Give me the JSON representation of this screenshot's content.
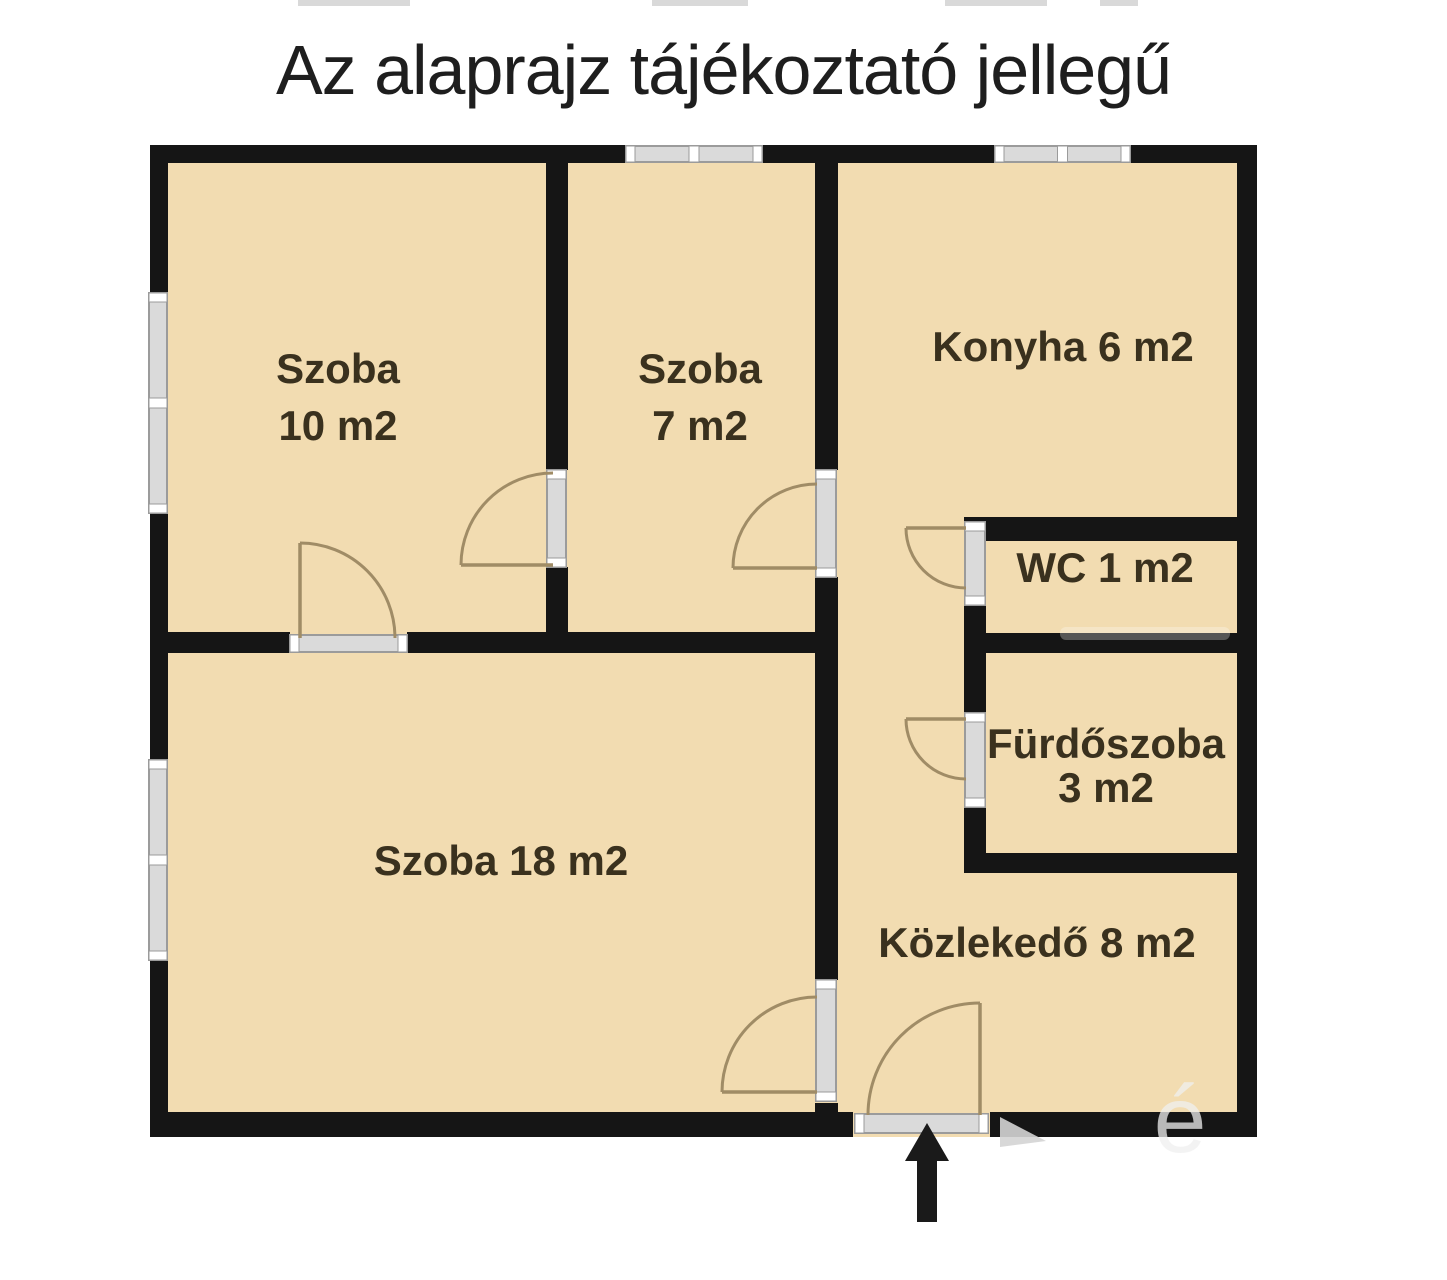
{
  "title": {
    "text": "Az alaprajz tájékoztató jellegű"
  },
  "colors": {
    "background": "#ffffff",
    "floor": "#f2dcb1",
    "wall": "#151515",
    "frame_fill": "#dadada",
    "frame_edge": "#9b9b9b",
    "frame_cap": "#ffffff",
    "arc": "#a08c66",
    "label": "#3a311e",
    "title": "#1e1e1e",
    "arrow": "#1a1a1a",
    "watermark": "#d4d4d4"
  },
  "floor": {
    "x": 150,
    "y": 145,
    "w": 1107,
    "h": 992
  },
  "walls": [
    {
      "name": "outer-top",
      "x": 150,
      "y": 145,
      "w": 1107,
      "h": 18
    },
    {
      "name": "outer-left",
      "x": 150,
      "y": 145,
      "w": 18,
      "h": 992
    },
    {
      "name": "outer-right",
      "x": 1237,
      "y": 145,
      "w": 20,
      "h": 992
    },
    {
      "name": "outer-bottom-left",
      "x": 150,
      "y": 1112,
      "w": 703,
      "h": 25
    },
    {
      "name": "outer-bottom-right",
      "x": 990,
      "y": 1112,
      "w": 267,
      "h": 25
    },
    {
      "name": "divider-szoba10-szoba7-upper",
      "x": 546,
      "y": 163,
      "w": 22,
      "h": 307
    },
    {
      "name": "divider-szoba10-szoba7-lower",
      "x": 546,
      "y": 567,
      "w": 22,
      "h": 86
    },
    {
      "name": "central-wall-upper",
      "x": 815,
      "y": 163,
      "w": 23,
      "h": 307
    },
    {
      "name": "central-wall-middle",
      "x": 815,
      "y": 577,
      "w": 23,
      "h": 403
    },
    {
      "name": "central-wall-stub",
      "x": 815,
      "y": 1103,
      "w": 23,
      "h": 9
    },
    {
      "name": "szoba10-szoba18-wall-left",
      "x": 168,
      "y": 632,
      "w": 122,
      "h": 21
    },
    {
      "name": "szoba10-szoba18-wall-right",
      "x": 407,
      "y": 632,
      "w": 431,
      "h": 21
    },
    {
      "name": "konyha-bottom-wall",
      "x": 964,
      "y": 517,
      "w": 273,
      "h": 24
    },
    {
      "name": "wc-furdo-divider-wall",
      "x": 964,
      "y": 633,
      "w": 273,
      "h": 20
    },
    {
      "name": "furdo-bottom-wall",
      "x": 964,
      "y": 853,
      "w": 273,
      "h": 20
    },
    {
      "name": "wc-left-wall",
      "x": 964,
      "y": 605,
      "w": 22,
      "h": 108
    },
    {
      "name": "furdo-left-wall",
      "x": 964,
      "y": 807,
      "w": 22,
      "h": 46
    }
  ],
  "windows": [
    {
      "name": "window-top-szoba7",
      "x": 626,
      "y": 146,
      "w": 136,
      "h": 16,
      "orient": "h"
    },
    {
      "name": "window-top-konyha",
      "x": 995,
      "y": 146,
      "w": 135,
      "h": 16,
      "orient": "h"
    },
    {
      "name": "window-left-szoba10",
      "x": 149,
      "y": 293,
      "w": 18,
      "h": 220,
      "orient": "v"
    },
    {
      "name": "window-left-szoba18",
      "x": 149,
      "y": 760,
      "w": 18,
      "h": 200,
      "orient": "v"
    }
  ],
  "door_frames": [
    {
      "name": "doorframe-szoba10",
      "x": 290,
      "y": 635,
      "w": 117,
      "h": 17,
      "orient": "h"
    },
    {
      "name": "doorframe-szoba10-szoba7",
      "x": 547,
      "y": 470,
      "w": 19,
      "h": 97,
      "orient": "v"
    },
    {
      "name": "doorframe-szoba7-hall",
      "x": 816,
      "y": 470,
      "w": 20,
      "h": 107,
      "orient": "v"
    },
    {
      "name": "doorframe-wc",
      "x": 965,
      "y": 522,
      "w": 20,
      "h": 83,
      "orient": "v"
    },
    {
      "name": "doorframe-furdoszoba",
      "x": 965,
      "y": 713,
      "w": 20,
      "h": 94,
      "orient": "v"
    },
    {
      "name": "doorframe-szoba18-hall",
      "x": 816,
      "y": 980,
      "w": 20,
      "h": 121,
      "orient": "v"
    },
    {
      "name": "doorframe-entrance",
      "x": 855,
      "y": 1114,
      "w": 133,
      "h": 19,
      "orient": "h"
    }
  ],
  "doors": [
    {
      "name": "door-szoba10",
      "leaf": [
        300,
        638,
        300,
        543
      ],
      "arc": "M 300 543 A 95 95 0 0 1 395 638"
    },
    {
      "name": "door-szoba10-szoba7",
      "leaf": [
        553,
        565,
        461,
        565
      ],
      "arc": "M 461 565 A 92 92 0 0 1 553 473"
    },
    {
      "name": "door-szoba7-hall",
      "leaf": [
        817,
        568,
        733,
        568
      ],
      "arc": "M 733 568 A 84 84 0 0 1 817 484"
    },
    {
      "name": "door-wc",
      "leaf": [
        966,
        528,
        906,
        528
      ],
      "arc": "M 906 528 A 60 60 0 0 0 966 588"
    },
    {
      "name": "door-furdoszoba",
      "leaf": [
        966,
        719,
        906,
        719
      ],
      "arc": "M 906 719 A 60 60 0 0 0 966 779"
    },
    {
      "name": "door-szoba18-hall",
      "leaf": [
        817,
        1092,
        722,
        1092
      ],
      "arc": "M 722 1092 A 95 95 0 0 1 817 997"
    },
    {
      "name": "door-entrance",
      "leaf": [
        980,
        1115,
        980,
        1003
      ],
      "arc": "M 980 1003 A 112 112 0 0 0 868 1115"
    }
  ],
  "rooms": [
    {
      "name": "room-label-szoba10",
      "lines": [
        "Szoba",
        "10 m2"
      ],
      "cx": 338,
      "cy": 368,
      "line_h": 57
    },
    {
      "name": "room-label-szoba7",
      "lines": [
        "Szoba",
        "7 m2"
      ],
      "cx": 700,
      "cy": 368,
      "line_h": 57
    },
    {
      "name": "room-label-konyha",
      "lines": [
        "Konyha 6 m2"
      ],
      "cx": 1063,
      "cy": 346,
      "line_h": 57
    },
    {
      "name": "room-label-wc",
      "lines": [
        "WC 1 m2"
      ],
      "cx": 1105,
      "cy": 567,
      "line_h": 57
    },
    {
      "name": "room-label-furdoszoba",
      "lines": [
        "Fürdőszoba",
        "3 m2"
      ],
      "cx": 1106,
      "cy": 743,
      "line_h": 44
    },
    {
      "name": "room-label-szoba18",
      "lines": [
        "Szoba 18 m2"
      ],
      "cx": 501,
      "cy": 860,
      "line_h": 57
    },
    {
      "name": "room-label-kozlekedo",
      "lines": [
        "Közlekedő 8 m2"
      ],
      "cx": 1037,
      "cy": 942,
      "line_h": 57
    }
  ],
  "label_font_size": 42,
  "entrance_arrow": {
    "points": "927,1123 905,1161 917,1161 917,1222 937,1222 937,1161 949,1161"
  },
  "watermarks": {
    "triangle_points": "1000,1117 1046,1141 1000,1147",
    "accent_char": "é",
    "accent_x": 1180,
    "accent_y": 1152,
    "accent_size": 95,
    "wall_smudge": {
      "x": 1060,
      "y": 627,
      "w": 170,
      "h": 13
    },
    "top_smudges": [
      {
        "x": 298,
        "w": 112
      },
      {
        "x": 652,
        "w": 96
      },
      {
        "x": 945,
        "w": 102
      },
      {
        "x": 1100,
        "w": 38
      }
    ]
  }
}
